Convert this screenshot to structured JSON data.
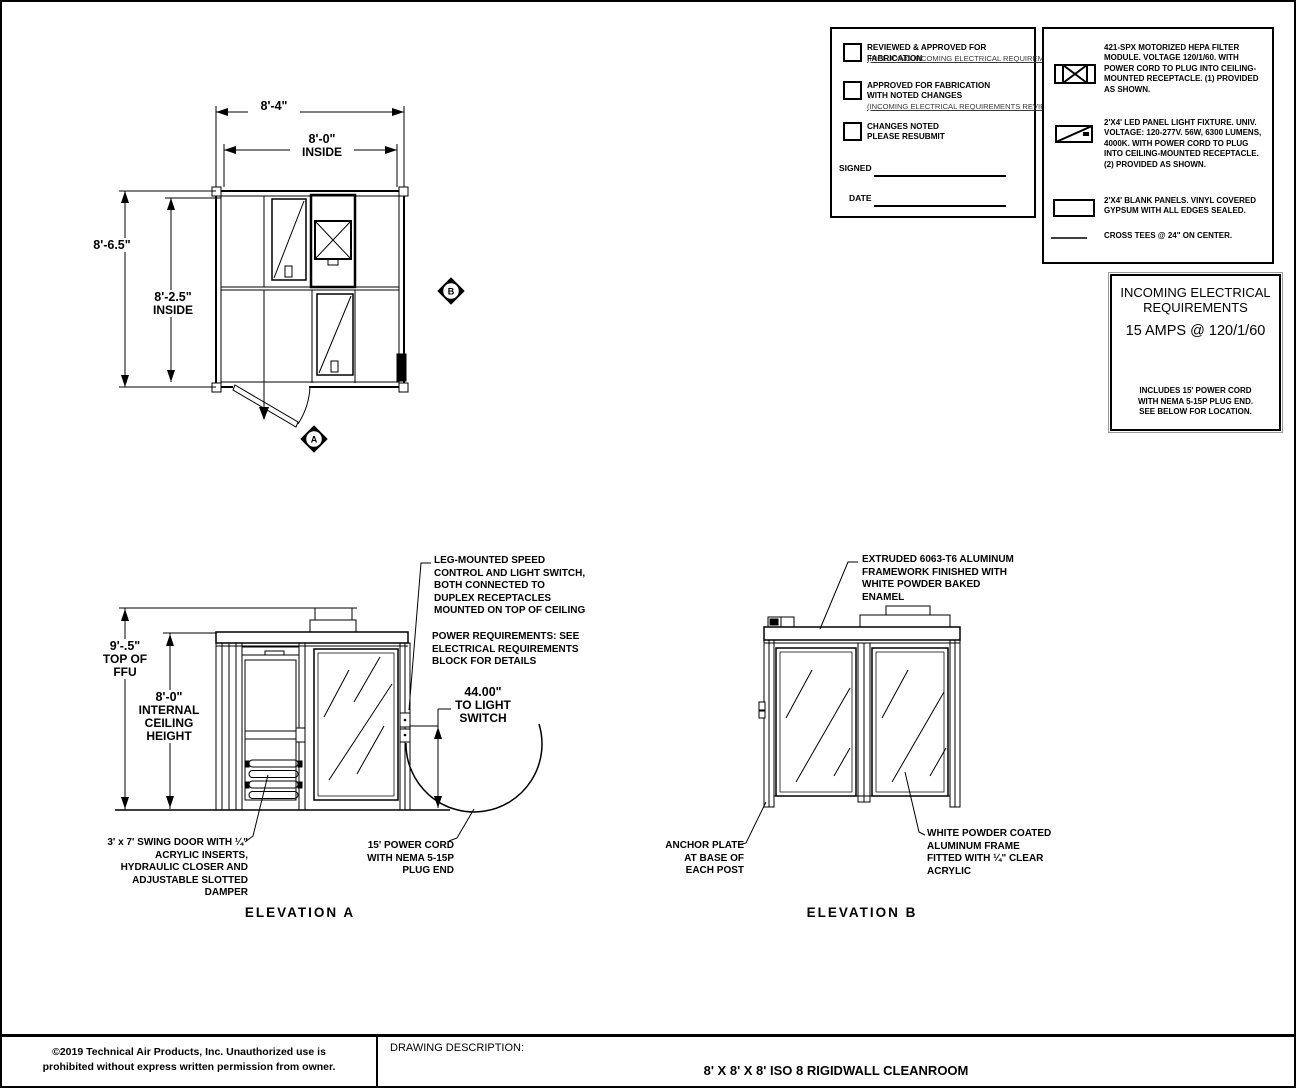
{
  "plan": {
    "dim_width_outer": "8'-4\"",
    "dim_width_inner": "8'-0\"",
    "dim_width_inner_label": "INSIDE",
    "dim_depth_outer": "8'-6.5\"",
    "dim_depth_inner": "8'-2.5\"",
    "dim_depth_inner_label": "INSIDE",
    "marker_a": "A",
    "marker_b": "B"
  },
  "approval": {
    "items": [
      {
        "line1": "REVIEWED & APPROVED FOR FABRICATION",
        "line2": "",
        "note": "(INCLUDING INCOMING ELECTRICAL REQUIREMENTS)"
      },
      {
        "line1": "APPROVED FOR FABRICATION",
        "line2": "WITH NOTED CHANGES",
        "note": "(INCOMING ELECTRICAL REQUIREMENTS REVIEWED)"
      },
      {
        "line1": "CHANGES NOTED",
        "line2": "PLEASE RESUBMIT",
        "note": ""
      }
    ],
    "signed_label": "SIGNED",
    "date_label": "DATE"
  },
  "legend": {
    "items": [
      {
        "symbol": "hepa-filter-module",
        "text": "421-SPX  MOTORIZED HEPA FILTER MODULE. VOLTAGE 120/1/60. WITH POWER CORD TO PLUG INTO CEILING-MOUNTED RECEPTACLE. (1) PROVIDED AS SHOWN."
      },
      {
        "symbol": "led-panel-light",
        "text": "2'X4' LED PANEL LIGHT FIXTURE. UNIV. VOLTAGE: 120-277V.  56W, 6300 LUMENS, 4000K. WITH POWER CORD TO PLUG INTO CEILING-MOUNTED RECEPTACLE. (2) PROVIDED AS SHOWN."
      },
      {
        "symbol": "blank-panel",
        "text": "2'X4' BLANK PANELS. VINYL COVERED GYPSUM WITH ALL EDGES SEALED."
      },
      {
        "symbol": "cross-tee",
        "text": "CROSS TEES @ 24\" ON CENTER."
      }
    ]
  },
  "electrical": {
    "title": "INCOMING ELECTRICAL REQUIREMENTS",
    "amps": "15 AMPS @ 120/1/60",
    "note": "INCLUDES 15' POWER CORD WITH NEMA 5-15P PLUG END. SEE BELOW FOR LOCATION."
  },
  "elevation_a": {
    "dim_height_value": "9'-.5\"",
    "dim_height_label": "TOP OF FFU",
    "dim_ceiling_value": "8'-0\"",
    "dim_ceiling_label": "INTERNAL CEILING HEIGHT",
    "dim_switch_value": "44.00\"",
    "dim_switch_label": "TO LIGHT SWITCH",
    "ann_leg_mounted": "LEG-MOUNTED SPEED CONTROL AND LIGHT SWITCH, BOTH CONNECTED TO DUPLEX RECEPTACLES MOUNTED ON TOP OF CEILING",
    "ann_power_req": "POWER REQUIREMENTS: SEE ELECTRICAL REQUIREMENTS BLOCK FOR DETAILS",
    "ann_swing_door": "3' x 7' SWING DOOR WITH ¼\" ACRYLIC INSERTS, HYDRAULIC CLOSER AND ADJUSTABLE SLOTTED DAMPER",
    "ann_power_cord": "15' POWER CORD WITH NEMA 5-15P PLUG END",
    "title": "ELEVATION A"
  },
  "elevation_b": {
    "ann_framework": "EXTRUDED 6063-T6 ALUMINUM FRAMEWORK FINISHED WITH WHITE POWDER BAKED ENAMEL",
    "ann_anchor": "ANCHOR PLATE AT BASE OF EACH POST",
    "ann_acrylic": "WHITE POWDER COATED ALUMINUM FRAME FITTED WITH ¼\" CLEAR ACRYLIC",
    "title": "ELEVATION B"
  },
  "title_block": {
    "copyright_line1": "©2019 Technical Air Products, Inc.  Unauthorized use is",
    "copyright_line2": "prohibited without express written permission from owner.",
    "description_label": "DRAWING DESCRIPTION:",
    "title": "8' X 8' X 8' ISO 8 RIGIDWALL CLEANROOM"
  }
}
